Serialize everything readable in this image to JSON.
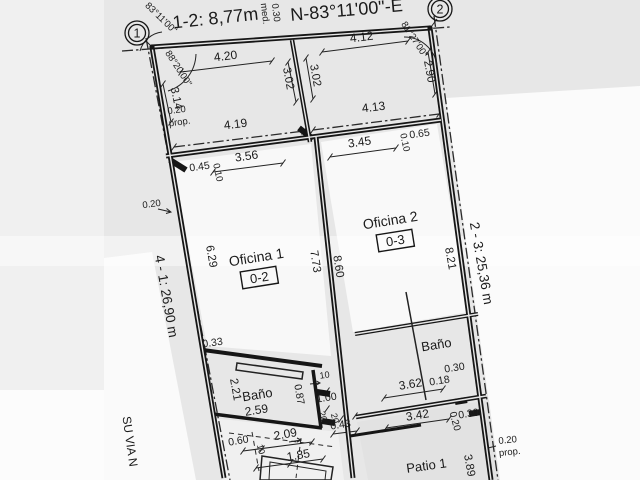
{
  "document": {
    "type": "scanned cadastral floor plan",
    "colors": {
      "paper": "#e7e7e7",
      "ink": "#1a1a1a",
      "outside_white": "#fbfbfb",
      "muted_text": "#8d8d8d"
    }
  },
  "vertices": [
    {
      "name": "vertex-1-marker",
      "label": "1",
      "x": 137,
      "y": 33
    },
    {
      "name": "vertex-2-marker",
      "label": "2",
      "x": 440,
      "y": 9
    }
  ],
  "annotations": {
    "boundary": [
      {
        "name": "dim-segment-1-2",
        "text": "1-2: 8,77m",
        "x": 216,
        "y": 24,
        "r": -6,
        "s": 18
      },
      {
        "name": "bearing-north",
        "text": "N-83°11'00\"-E",
        "x": 347,
        "y": 16,
        "r": -5,
        "s": 18
      },
      {
        "name": "dim-wall-0-30",
        "text": "0.30",
        "x": 273,
        "y": 13,
        "r": 83,
        "s": 9.5
      },
      {
        "name": "label-med",
        "text": "med.",
        "x": 262,
        "y": 14,
        "r": 83,
        "s": 9.5
      },
      {
        "name": "angle-corner-1-outer",
        "text": "83°11'00\"",
        "x": 159,
        "y": 20,
        "r": 44,
        "s": 9.5
      },
      {
        "name": "angle-corner-1-inner",
        "text": "88°20'00\"",
        "x": 176,
        "y": 70,
        "r": 57,
        "s": 9.5
      },
      {
        "name": "angle-corner-2",
        "text": "81°27'00\"",
        "x": 412,
        "y": 41,
        "r": 57,
        "s": 9.5
      },
      {
        "name": "dim-left-boundary",
        "text": "4 - 1: 26,90 m",
        "x": 162,
        "y": 297,
        "r": 80,
        "s": 13.5
      },
      {
        "name": "dim-right-boundary",
        "text": "2 - 3: 25,36 m",
        "x": 477,
        "y": 264,
        "r": 80,
        "s": 13.5
      },
      {
        "name": "street-name",
        "text": "SU VIA N",
        "x": 126,
        "y": 442,
        "r": 82,
        "s": 12,
        "muted": true
      },
      {
        "name": "dim-prop-right",
        "text": "0.20",
        "x": 508,
        "y": 443,
        "r": -6,
        "s": 9.5
      },
      {
        "name": "label-prop-right",
        "text": "prop.",
        "x": 510,
        "y": 455,
        "r": -6,
        "s": 9.5
      },
      {
        "name": "dim-right-3-89",
        "text": "3.89",
        "x": 466,
        "y": 466,
        "r": 80,
        "s": 11.5
      }
    ],
    "front_areas": [
      {
        "name": "dim-4-20",
        "text": "4.20",
        "x": 226,
        "y": 60,
        "r": -7,
        "s": 12
      },
      {
        "name": "dim-3-14",
        "text": "3.14",
        "x": 173,
        "y": 99,
        "r": 78,
        "s": 11.5
      },
      {
        "name": "dim-0-20-prop",
        "text": "0.20",
        "x": 177,
        "y": 113,
        "r": -8,
        "s": 9.5
      },
      {
        "name": "label-prop-left",
        "text": "prop.",
        "x": 180,
        "y": 125,
        "r": -8,
        "s": 9.5
      },
      {
        "name": "dim-4-19",
        "text": "4.19",
        "x": 236,
        "y": 128,
        "r": -7,
        "s": 12
      },
      {
        "name": "dim-3-02-left",
        "text": "3.02",
        "x": 285,
        "y": 79,
        "r": 80,
        "s": 11.5
      },
      {
        "name": "dim-3-02-right",
        "text": "3.02",
        "x": 312,
        "y": 76,
        "r": 80,
        "s": 11.5
      },
      {
        "name": "dim-4-12",
        "text": "4.12",
        "x": 362,
        "y": 41,
        "r": -7,
        "s": 12
      },
      {
        "name": "dim-2-90",
        "text": "2.90",
        "x": 426,
        "y": 72,
        "r": 80,
        "s": 11.5
      },
      {
        "name": "dim-4-13",
        "text": "4.13",
        "x": 374,
        "y": 111,
        "r": -7,
        "s": 12
      }
    ],
    "offices": [
      {
        "name": "dim-0-45",
        "text": "0.45",
        "x": 200,
        "y": 170,
        "r": -8,
        "s": 10.5
      },
      {
        "name": "dim-0-10-left",
        "text": "0.10",
        "x": 215,
        "y": 173,
        "r": 78,
        "s": 9.5
      },
      {
        "name": "dim-3-56",
        "text": "3.56",
        "x": 247,
        "y": 160,
        "r": -8,
        "s": 12
      },
      {
        "name": "dim-3-45",
        "text": "3.45",
        "x": 360,
        "y": 146,
        "r": -8,
        "s": 12
      },
      {
        "name": "dim-0-10-right",
        "text": "0.10",
        "x": 402,
        "y": 143,
        "r": 78,
        "s": 9.5
      },
      {
        "name": "dim-0-65",
        "text": "0.65",
        "x": 420,
        "y": 137,
        "r": -8,
        "s": 10.5
      },
      {
        "name": "dim-0-20-left-wall",
        "text": "0.20",
        "x": 152,
        "y": 207,
        "r": -8,
        "s": 9.5
      },
      {
        "name": "room-oficina-1",
        "text": "Oficina 1",
        "x": 257,
        "y": 262,
        "r": -9,
        "s": 14
      },
      {
        "name": "room-code-0-2",
        "text": "0-2",
        "x": 260,
        "y": 282,
        "r": -9,
        "s": 13,
        "box": true
      },
      {
        "name": "room-oficina-2",
        "text": "Oficina 2",
        "x": 391,
        "y": 225,
        "r": -9,
        "s": 14
      },
      {
        "name": "room-code-0-3",
        "text": "0-3",
        "x": 396,
        "y": 245,
        "r": -9,
        "s": 13,
        "box": true
      },
      {
        "name": "dim-6-29",
        "text": "6.29",
        "x": 208,
        "y": 257,
        "r": 80,
        "s": 11.5
      },
      {
        "name": "dim-7-73",
        "text": "7.73",
        "x": 312,
        "y": 262,
        "r": 81,
        "s": 11.5
      },
      {
        "name": "dim-8-60",
        "text": "8.60",
        "x": 335,
        "y": 267,
        "r": 81,
        "s": 11.5
      },
      {
        "name": "dim-8-21",
        "text": "8.21",
        "x": 447,
        "y": 259,
        "r": 80,
        "s": 11.5
      }
    ],
    "bath_left": [
      {
        "name": "dim-0-33",
        "text": "0.33",
        "x": 213,
        "y": 346,
        "r": -8,
        "s": 10.5
      },
      {
        "name": "dim-2-21",
        "text": "2.21",
        "x": 232,
        "y": 390,
        "r": 80,
        "s": 11.5
      },
      {
        "name": "room-bano-1",
        "text": "Baño",
        "x": 258,
        "y": 399,
        "r": -9,
        "s": 13
      },
      {
        "name": "dim-2-59",
        "text": "2.59",
        "x": 257,
        "y": 414,
        "r": -9,
        "s": 12
      },
      {
        "name": "dim-0-87",
        "text": "0.87",
        "x": 296,
        "y": 395,
        "r": 80,
        "s": 10.5
      },
      {
        "name": "dim-0-10-door",
        "text": "10",
        "x": 325,
        "y": 378,
        "r": -8,
        "s": 9
      },
      {
        "name": "dim-1-00",
        "text": "1.00",
        "x": 327,
        "y": 401,
        "r": -9,
        "s": 10.5
      },
      {
        "name": "dim-0-20-a",
        "text": "20",
        "x": 320,
        "y": 417,
        "r": 75,
        "s": 9
      },
      {
        "name": "dim-0-20-b",
        "text": "20",
        "x": 332,
        "y": 419,
        "r": 75,
        "s": 9
      },
      {
        "name": "dim-0-43",
        "text": "0.43",
        "x": 341,
        "y": 428,
        "r": -9,
        "s": 10.5
      }
    ],
    "vestibule": [
      {
        "name": "dim-0-60",
        "text": "0.60",
        "x": 239,
        "y": 444,
        "r": -10,
        "s": 10.5
      },
      {
        "name": "dim-0-10-vest",
        "text": "10",
        "x": 258,
        "y": 450,
        "r": 75,
        "s": 9
      },
      {
        "name": "dim-2-09",
        "text": "2.09",
        "x": 286,
        "y": 438,
        "r": -10,
        "s": 12
      },
      {
        "name": "dim-1-85",
        "text": "1.85",
        "x": 299,
        "y": 459,
        "r": -10,
        "s": 12
      }
    ],
    "bath_right_patio": [
      {
        "name": "room-bano-2",
        "text": "Baño",
        "x": 437,
        "y": 349,
        "r": -9,
        "s": 13
      },
      {
        "name": "dim-0-30-door",
        "text": "0.30",
        "x": 455,
        "y": 371,
        "r": -9,
        "s": 10.5
      },
      {
        "name": "dim-0-18",
        "text": "0.18",
        "x": 440,
        "y": 384,
        "r": -9,
        "s": 10.5
      },
      {
        "name": "dim-3-62",
        "text": "3.62",
        "x": 411,
        "y": 388,
        "r": -9,
        "s": 12
      },
      {
        "name": "dim-3-42",
        "text": "3.42",
        "x": 418,
        "y": 419,
        "r": -9,
        "s": 12
      },
      {
        "name": "dim-0-20-patio",
        "text": "0.20",
        "x": 452,
        "y": 422,
        "r": 75,
        "s": 10
      },
      {
        "name": "dim-0-30-patio",
        "text": "0.30",
        "x": 469,
        "y": 417,
        "r": -9,
        "s": 10.5
      },
      {
        "name": "room-patio-1",
        "text": "Patio 1",
        "x": 427,
        "y": 470,
        "r": -8,
        "s": 13
      }
    ]
  }
}
